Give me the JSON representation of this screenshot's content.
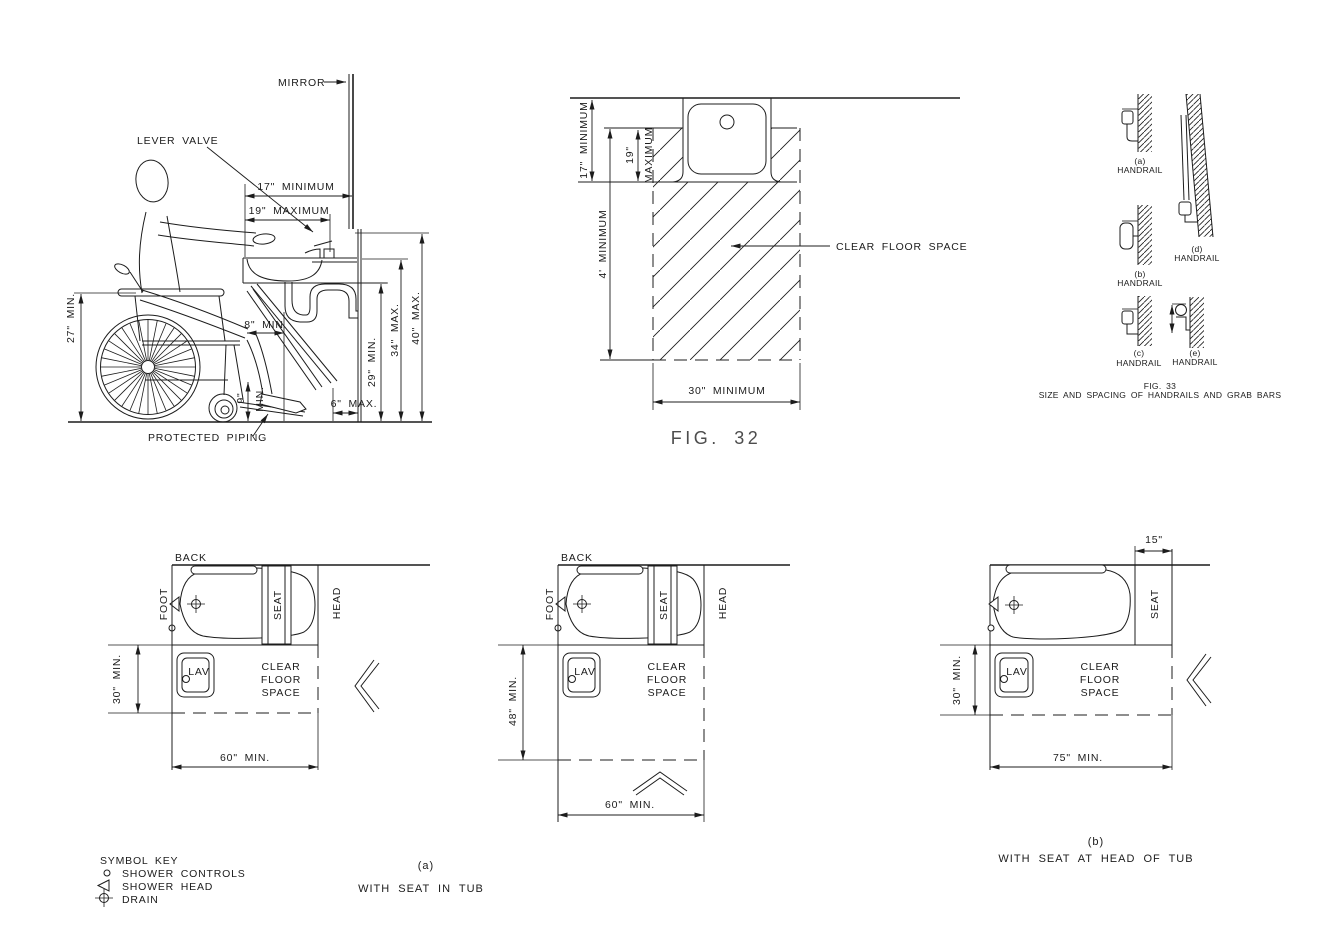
{
  "colors": {
    "line": "#1c1c1c",
    "background": "#ffffff",
    "caption_gray": "#4d4d4d"
  },
  "fig1": {
    "labels": {
      "mirror": "MIRROR",
      "lever_valve": "LEVER VALVE",
      "protected_piping": "PROTECTED PIPING"
    },
    "dims": {
      "d17": "17\" MINIMUM",
      "d19": "19\" MAXIMUM",
      "d27": "27\" MIN.",
      "d8": "8\" MIN",
      "d9": "9\"",
      "d9_min": "MIN.",
      "d6": "6\" MAX.",
      "d29": "29\" MIN.",
      "d34": "34\" MAX.",
      "d40": "40\" MAX."
    }
  },
  "fig2": {
    "caption": "FIG.  32",
    "clear_floor_space": "CLEAR FLOOR SPACE",
    "dims": {
      "d17": "17\" MINIMUM",
      "d19": "19\"",
      "d19_max": "MAXIMUM",
      "d4": "4' MINIMUM",
      "d30": "30\" MINIMUM"
    }
  },
  "fig33": {
    "caption": "FIG. 33",
    "subtitle": "SIZE AND SPACING OF HANDRAILS AND GRAB BARS",
    "details": [
      {
        "tag": "(a)",
        "label": "HANDRAIL"
      },
      {
        "tag": "(b)",
        "label": "HANDRAIL"
      },
      {
        "tag": "(c)",
        "label": "HANDRAIL"
      },
      {
        "tag": "(d)",
        "label": "HANDRAIL"
      },
      {
        "tag": "(e)",
        "label": "HANDRAIL"
      }
    ]
  },
  "tubs": {
    "t1": {
      "back": "BACK",
      "foot": "FOOT",
      "head": "HEAD",
      "seat": "SEAT",
      "lav": "LAV",
      "cfs1": "CLEAR",
      "cfs2": "FLOOR",
      "cfs3": "SPACE",
      "dim_v": "30\" MIN.",
      "dim_h": "60\" MIN."
    },
    "t2": {
      "back": "BACK",
      "foot": "FOOT",
      "head": "HEAD",
      "seat": "SEAT",
      "lav": "LAV",
      "cfs1": "CLEAR",
      "cfs2": "FLOOR",
      "cfs3": "SPACE",
      "dim_v": "48\" MIN.",
      "dim_h": "60\" MIN."
    },
    "t3": {
      "seat": "SEAT",
      "lav": "LAV",
      "cfs1": "CLEAR",
      "cfs2": "FLOOR",
      "cfs3": "SPACE",
      "dim_v": "30\" MIN.",
      "dim_h": "75\" MIN.",
      "d15": "15\""
    },
    "caption_a_tag": "(a)",
    "caption_a": "WITH SEAT IN TUB",
    "caption_b_tag": "(b)",
    "caption_b": "WITH SEAT AT HEAD OF TUB"
  },
  "symbol_key": {
    "title": "SYMBOL KEY",
    "items": [
      {
        "icon": "shower-controls-icon",
        "label": "SHOWER CONTROLS"
      },
      {
        "icon": "shower-head-icon",
        "label": "SHOWER HEAD"
      },
      {
        "icon": "drain-icon",
        "label": "DRAIN"
      }
    ]
  }
}
